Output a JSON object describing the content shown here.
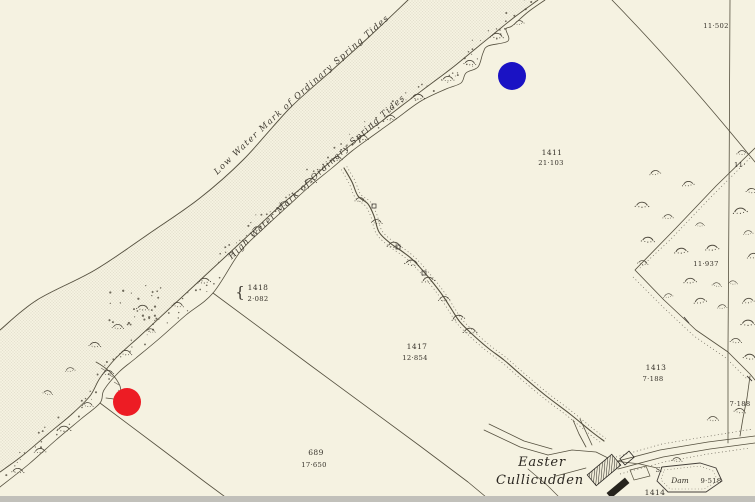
{
  "map_labels": {
    "low_water_mark": "Low Water Mark of Ordinary Spring Tides",
    "high_water_mark": "High Water Mark of Ordinary Spring Tides",
    "place_name_line1": "Easter",
    "place_name_line2": "Cullicudden",
    "dam_label": "Dam",
    "sluice_label": "Sl"
  },
  "parcels": {
    "p1411": {
      "number": "1411",
      "area": "21·103"
    },
    "p1418": {
      "number": "1418",
      "area": "2·082",
      "brace": "{"
    },
    "p1417": {
      "number": "1417",
      "area": "12·854"
    },
    "p1413": {
      "number": "1413",
      "area": "7·188"
    },
    "p689": {
      "number": "689",
      "area": "17·650"
    },
    "p1414": {
      "number": "1414"
    }
  },
  "area_values": {
    "top_right": "11·502",
    "scrub_strip": "11·937",
    "right_edge_partial": "11·",
    "east_field": "7·188",
    "dam_area": "9·518"
  },
  "markers": {
    "red": {
      "color": "#ed1c24"
    },
    "blue": {
      "color": "#1a12c4"
    }
  },
  "colors": {
    "paper": "#f5f2e1",
    "ink": "#55503f",
    "sheet_edge": "#c1c0ba"
  }
}
